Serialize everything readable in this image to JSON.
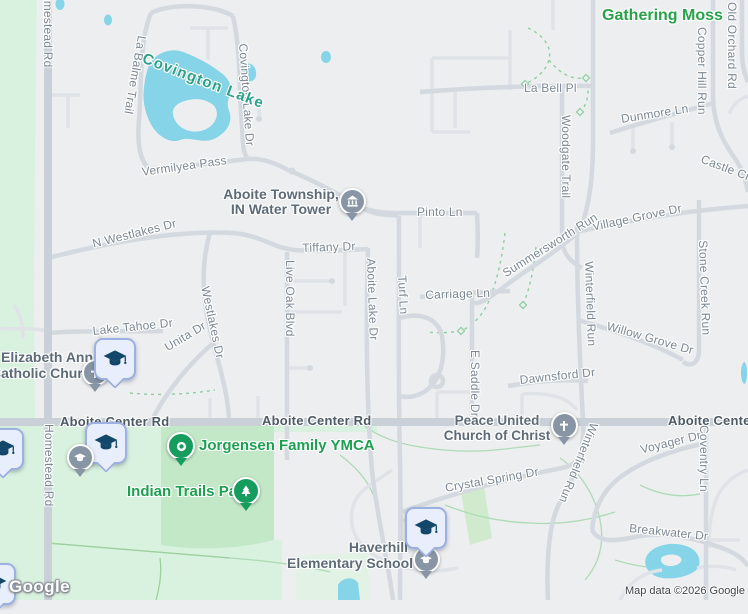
{
  "map": {
    "logo": "Google",
    "attribution": "Map data ©2026 Google"
  },
  "roads": {
    "homestead": "Homestead Rd",
    "aboite_center": "Aboite Center Rd",
    "la_balme": "La Balme Trail",
    "covington_lake_dr": "Covington Lake Dr",
    "vermilyea": "Vermilyea Pass",
    "n_westlakes": "N Westlakes Dr",
    "westlakes": "Westlakes Dr",
    "unita": "Unita Dr",
    "lake_tahoe": "Lake Tahoe Dr",
    "tiffany": "Tiffany Dr",
    "live_oak": "Live Oak Blvd",
    "aboite_lake": "Aboite Lake Dr",
    "turf": "Turf Ln",
    "pinto": "Pinto Ln",
    "carriage": "Carriage Ln",
    "e_saddle": "E Saddle Dr",
    "la_bell": "La Bell Pl",
    "dunmore": "Dunmore Ln",
    "woodgate": "Woodgate Trail",
    "copper_hill": "Copper Hill Run",
    "old_orchard": "Old Orchard Rd",
    "castle_creek": "Castle Creek",
    "village_grove": "Village Grove Dr",
    "summersworth": "Summersworth Run",
    "winterfield": "Winterfield Run",
    "stone_creek": "Stone Creek Run",
    "willow_grove": "Willow Grove Dr",
    "dawnsford": "Dawnsford Dr",
    "crystal_spring": "Crystal Spring Dr",
    "voyager": "Voyager Dr",
    "coventry": "Coventry Ln",
    "breakwater": "Breakwater Dr"
  },
  "places": {
    "gathering_moss": "Gathering Moss",
    "covington_lake": "Covington Lake",
    "water_tower_line1": "Aboite Township,",
    "water_tower_line2": "IN Water Tower",
    "church1_line1": "Elizabeth Ann",
    "church1_line2": "Catholic Church",
    "church2_line1": "Peace United",
    "church2_line2": "Church of Christ",
    "ymca": "Jorgensen Family YMCA",
    "park": "Indian Trails Park",
    "school_line1": "Haverhill",
    "school_line2": "Elementary School"
  },
  "icons": {
    "school": "graduation-cap",
    "church": "cross",
    "park": "tree",
    "water_tower": "monument",
    "generic_poi": "dot"
  },
  "colors": {
    "land": "#eceef0",
    "water": "#85d4e8",
    "natural_green": "#d9f2df",
    "park_green": "#c3e8c7",
    "road_major": "#c9d0d7",
    "road_minor": "#dfe3e8",
    "pin_gray": "#8795a4",
    "pin_green": "#169c5d",
    "school_pin_fill": "#e9eefc",
    "school_pin_border": "#9db0e2",
    "cap_icon": "#12476a"
  }
}
